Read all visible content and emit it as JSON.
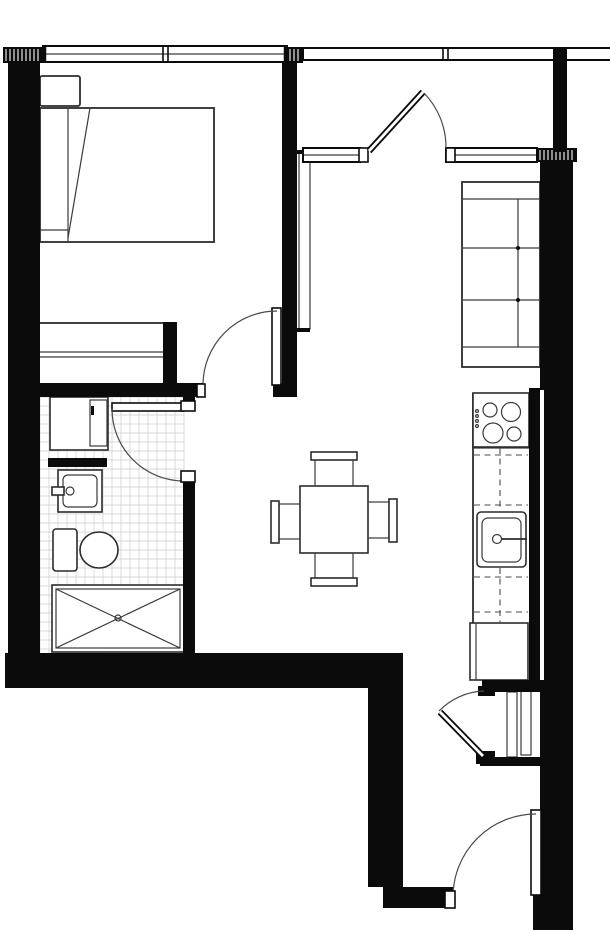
{
  "canvas": {
    "width": 610,
    "height": 932,
    "background": "#ffffff",
    "wall_color": "#0b0b0b",
    "line_color": "#3a3a3a"
  },
  "styles": {
    "wall": {
      "fill": "#0b0b0b"
    },
    "thin": {
      "stroke": "#3a3a3a",
      "sw": 1.2
    },
    "med": {
      "stroke": "#2c2c2c",
      "sw": 1.8
    },
    "fixture": {
      "fill": "#ffffff",
      "stroke": "#2c2c2c",
      "sw": 1.6
    },
    "cap": {
      "fill": "#ffffff",
      "stroke": "#0b0b0b",
      "sw": 1.6
    },
    "dash": {
      "stroke": "#4a4a4a",
      "sw": 1.1,
      "dash": "6 4.5"
    },
    "arc": {
      "stroke": "#4a4a4a",
      "sw": 1.2
    },
    "grid": {
      "stroke": "#cccccc",
      "sw": 0.7
    },
    "blk": {
      "fill": "#0b0b0b"
    }
  },
  "plan": {
    "elements": [
      {
        "n": "bathroom-floor-tiles",
        "t": "grid",
        "x": 40,
        "y": 397,
        "w": 144,
        "h": 256,
        "step": 9
      },
      {
        "n": "bed-frame",
        "t": "rect",
        "s": "med",
        "x": 40,
        "y": 108,
        "w": 174,
        "h": 134
      },
      {
        "n": "bed-pillow",
        "t": "rect",
        "s": "med",
        "x": 40,
        "y": 76,
        "w": 40,
        "h": 30,
        "rx": 2
      },
      {
        "n": "bed-inner-line",
        "t": "line",
        "s": "thin",
        "x1": 68,
        "y1": 108,
        "x2": 68,
        "y2": 242
      },
      {
        "n": "bed-fold-line",
        "t": "line",
        "s": "thin",
        "x1": 90,
        "y1": 108,
        "x2": 68,
        "y2": 238
      },
      {
        "n": "bed-foot-line",
        "t": "line",
        "s": "thin",
        "x1": 40,
        "y1": 230,
        "x2": 68,
        "y2": 230
      },
      {
        "n": "wardrobe",
        "t": "rect",
        "s": "med",
        "x": 39,
        "y": 323,
        "w": 129,
        "h": 62
      },
      {
        "n": "wardrobe-track-1",
        "t": "line",
        "s": "thin",
        "x1": 39,
        "y1": 352,
        "x2": 168,
        "y2": 352
      },
      {
        "n": "wardrobe-track-2",
        "t": "line",
        "s": "thin",
        "x1": 39,
        "y1": 357,
        "x2": 168,
        "y2": 357
      },
      {
        "n": "tv-panel",
        "t": "rect",
        "s": "thin",
        "x": 299,
        "y": 153,
        "w": 11,
        "h": 176
      },
      {
        "n": "tv-panel-mount-top",
        "t": "rect",
        "s": "blk",
        "x": 297,
        "y": 150,
        "w": 13,
        "h": 4
      },
      {
        "n": "tv-panel-mount-bottom",
        "t": "rect",
        "s": "blk",
        "x": 297,
        "y": 328,
        "w": 13,
        "h": 4
      },
      {
        "n": "sofa-outline",
        "t": "rect",
        "s": "med",
        "x": 462,
        "y": 182,
        "w": 78,
        "h": 185
      },
      {
        "n": "sofa-armrest-top-line",
        "t": "line",
        "s": "thin",
        "x1": 462,
        "y1": 199,
        "x2": 540,
        "y2": 199
      },
      {
        "n": "sofa-armrest-bottom-line",
        "t": "line",
        "s": "thin",
        "x1": 462,
        "y1": 347,
        "x2": 540,
        "y2": 347
      },
      {
        "n": "sofa-backrest-line",
        "t": "line",
        "s": "thin",
        "x1": 518,
        "y1": 199,
        "x2": 518,
        "y2": 347
      },
      {
        "n": "sofa-cushion-line-1",
        "t": "line",
        "s": "thin",
        "x1": 463,
        "y1": 248,
        "x2": 539,
        "y2": 248
      },
      {
        "n": "sofa-cushion-line-2",
        "t": "line",
        "s": "thin",
        "x1": 463,
        "y1": 300,
        "x2": 539,
        "y2": 300
      },
      {
        "n": "sofa-joint-dot-1",
        "t": "circle",
        "s": "blk",
        "cx": 518,
        "cy": 248,
        "r": 2
      },
      {
        "n": "sofa-joint-dot-2",
        "t": "circle",
        "s": "blk",
        "cx": 518,
        "cy": 300,
        "r": 2
      },
      {
        "n": "dining-table",
        "t": "rect",
        "s": "fixture",
        "x": 300,
        "y": 486,
        "w": 68,
        "h": 67
      },
      {
        "n": "chair-top-back",
        "t": "rect",
        "s": "fixture",
        "x": 311,
        "y": 452,
        "w": 46,
        "h": 8
      },
      {
        "n": "chair-top-seat",
        "t": "rect",
        "s": "thin",
        "x": 315,
        "y": 460,
        "w": 38,
        "h": 26
      },
      {
        "n": "chair-bottom-seat",
        "t": "rect",
        "s": "thin",
        "x": 315,
        "y": 553,
        "w": 38,
        "h": 25
      },
      {
        "n": "chair-bottom-back",
        "t": "rect",
        "s": "fixture",
        "x": 311,
        "y": 578,
        "w": 46,
        "h": 8
      },
      {
        "n": "chair-right-seat",
        "t": "rect",
        "s": "thin",
        "x": 368,
        "y": 502,
        "w": 21,
        "h": 36
      },
      {
        "n": "chair-right-back",
        "t": "rect",
        "s": "fixture",
        "x": 389,
        "y": 499,
        "w": 8,
        "h": 43
      },
      {
        "n": "chair-left-seat",
        "t": "rect",
        "s": "thin",
        "x": 279,
        "y": 504,
        "w": 21,
        "h": 35
      },
      {
        "n": "chair-left-back",
        "t": "rect",
        "s": "fixture",
        "x": 271,
        "y": 501,
        "w": 8,
        "h": 42
      },
      {
        "n": "kitchen-counter-edge",
        "t": "line",
        "s": "med",
        "x1": 473,
        "y1": 393,
        "x2": 473,
        "y2": 680
      },
      {
        "n": "counter-line-under-stove",
        "t": "line",
        "s": "thin",
        "x1": 473,
        "y1": 448,
        "x2": 529,
        "y2": 448
      },
      {
        "n": "stove",
        "t": "rect",
        "s": "fixture",
        "x": 473,
        "y": 393,
        "w": 56,
        "h": 54
      },
      {
        "n": "stove-burner-1",
        "t": "circle",
        "s": "thin",
        "cx": 490,
        "cy": 410,
        "r": 7
      },
      {
        "n": "stove-burner-2",
        "t": "circle",
        "s": "thin",
        "cx": 511,
        "cy": 412,
        "r": 9.5
      },
      {
        "n": "stove-burner-3",
        "t": "circle",
        "s": "thin",
        "cx": 493,
        "cy": 433,
        "r": 10
      },
      {
        "n": "stove-burner-4",
        "t": "circle",
        "s": "thin",
        "cx": 514,
        "cy": 434,
        "r": 7
      },
      {
        "n": "stove-control-dot-1",
        "t": "circle",
        "s": "thin",
        "cx": 477,
        "cy": 411,
        "r": 1.4
      },
      {
        "n": "stove-control-dot-2",
        "t": "circle",
        "s": "thin",
        "cx": 477,
        "cy": 416,
        "r": 1.4
      },
      {
        "n": "stove-control-dot-3",
        "t": "circle",
        "s": "thin",
        "cx": 477,
        "cy": 421,
        "r": 1.4
      },
      {
        "n": "stove-control-dot-4",
        "t": "circle",
        "s": "thin",
        "cx": 477,
        "cy": 426,
        "r": 1.4
      },
      {
        "n": "upper-cabinet-dash-1",
        "t": "line",
        "s": "dash",
        "x1": 500,
        "y1": 448,
        "x2": 500,
        "y2": 510
      },
      {
        "n": "upper-cabinet-dash-2",
        "t": "line",
        "s": "dash",
        "x1": 500,
        "y1": 568,
        "x2": 500,
        "y2": 622
      },
      {
        "n": "upper-cabinet-dash-3",
        "t": "line",
        "s": "dash",
        "x1": 474,
        "y1": 455,
        "x2": 528,
        "y2": 455
      },
      {
        "n": "upper-cabinet-dash-4",
        "t": "line",
        "s": "dash",
        "x1": 474,
        "y1": 505,
        "x2": 528,
        "y2": 505
      },
      {
        "n": "upper-cabinet-dash-5",
        "t": "line",
        "s": "dash",
        "x1": 474,
        "y1": 577,
        "x2": 528,
        "y2": 577
      },
      {
        "n": "upper-cabinet-dash-6",
        "t": "line",
        "s": "dash",
        "x1": 474,
        "y1": 612,
        "x2": 528,
        "y2": 612
      },
      {
        "n": "kitchen-sink",
        "t": "rect",
        "s": "fixture",
        "x": 477,
        "y": 512,
        "w": 49,
        "h": 55,
        "rx": 4
      },
      {
        "n": "kitchen-sink-basin",
        "t": "rect",
        "s": "thin",
        "x": 482,
        "y": 518,
        "w": 39,
        "h": 44,
        "rx": 6
      },
      {
        "n": "kitchen-faucet-knob",
        "t": "circle",
        "s": "thin",
        "cx": 497,
        "cy": 539,
        "r": 4.5
      },
      {
        "n": "kitchen-faucet-stem",
        "t": "line",
        "s": "med",
        "x1": 501,
        "y1": 539,
        "x2": 527,
        "y2": 539
      },
      {
        "n": "refrigerator",
        "t": "rect",
        "s": "fixture",
        "x": 470,
        "y": 623,
        "w": 58,
        "h": 57
      },
      {
        "n": "refrigerator-door-line",
        "t": "line",
        "s": "thin",
        "x1": 476,
        "y1": 623,
        "x2": 476,
        "y2": 680
      },
      {
        "n": "hall-closet-slide-panel-1",
        "t": "rect",
        "s": "thin",
        "x": 507,
        "y": 692,
        "w": 10,
        "h": 65
      },
      {
        "n": "hall-closet-slide-panel-2",
        "t": "rect",
        "s": "thin",
        "x": 521,
        "y": 690,
        "w": 10,
        "h": 65
      },
      {
        "n": "vanity-cabinet",
        "t": "rect",
        "s": "fixture",
        "x": 50,
        "y": 397,
        "w": 58,
        "h": 53
      },
      {
        "n": "vanity-door",
        "t": "rect",
        "s": "thin",
        "x": 90,
        "y": 400,
        "w": 17,
        "h": 46
      },
      {
        "n": "vanity-door-hinge",
        "t": "rect",
        "s": "blk",
        "x": 91,
        "y": 406,
        "w": 3,
        "h": 9
      },
      {
        "n": "bathroom-basin",
        "t": "rect",
        "s": "fixture",
        "x": 58,
        "y": 470,
        "w": 44,
        "h": 42
      },
      {
        "n": "bathroom-basin-inner",
        "t": "rect",
        "s": "thin",
        "x": 63,
        "y": 475,
        "w": 34,
        "h": 32,
        "rx": 5
      },
      {
        "n": "bathroom-faucet",
        "t": "rect",
        "s": "fixture",
        "x": 52,
        "y": 487,
        "w": 12,
        "h": 8
      },
      {
        "n": "bathroom-faucet-knob",
        "t": "circle",
        "s": "thin",
        "cx": 70,
        "cy": 491,
        "r": 4
      },
      {
        "n": "toilet-tank",
        "t": "rect",
        "s": "fixture",
        "x": 53,
        "y": 529,
        "w": 24,
        "h": 42,
        "rx": 3
      },
      {
        "n": "toilet-bowl",
        "t": "ellipse",
        "s": "fixture",
        "cx": 99,
        "cy": 550,
        "rx": 19,
        "ry": 18
      },
      {
        "n": "shower",
        "t": "rect",
        "s": "fixture",
        "x": 52,
        "y": 585,
        "w": 132,
        "h": 67
      },
      {
        "n": "shower-inner",
        "t": "rect",
        "s": "thin",
        "x": 56,
        "y": 589,
        "w": 124,
        "h": 59
      },
      {
        "n": "shower-x-line-1",
        "t": "line",
        "s": "thin",
        "x1": 56,
        "y1": 589,
        "x2": 180,
        "y2": 648
      },
      {
        "n": "shower-x-line-2",
        "t": "line",
        "s": "thin",
        "x1": 180,
        "y1": 589,
        "x2": 56,
        "y2": 648
      },
      {
        "n": "shower-drain",
        "t": "circle",
        "s": "thin",
        "cx": 118,
        "cy": 618,
        "r": 3
      },
      {
        "n": "left-exterior-wall",
        "t": "rect",
        "s": "wall",
        "x": 8,
        "y": 55,
        "w": 32,
        "h": 633
      },
      {
        "n": "bedroom-right-wall",
        "t": "rect",
        "s": "wall",
        "x": 282,
        "y": 60,
        "w": 15,
        "h": 337
      },
      {
        "n": "bathroom-top-wall",
        "t": "rect",
        "s": "wall",
        "x": 30,
        "y": 383,
        "w": 173,
        "h": 14
      },
      {
        "n": "wardrobe-side-wall-stub",
        "t": "rect",
        "s": "wall",
        "x": 163,
        "y": 322,
        "w": 14,
        "h": 61
      },
      {
        "n": "bedroom-door-side-block",
        "t": "rect",
        "s": "wall",
        "x": 273,
        "y": 383,
        "w": 24,
        "h": 14
      },
      {
        "n": "bathroom-right-wall-upper",
        "t": "rect",
        "s": "wall",
        "x": 183,
        "y": 383,
        "w": 12,
        "h": 20
      },
      {
        "n": "bathroom-right-wall-lower",
        "t": "rect",
        "s": "wall",
        "x": 183,
        "y": 479,
        "w": 12,
        "h": 176
      },
      {
        "n": "bottom-exterior-wall",
        "t": "rect",
        "s": "wall",
        "x": 5,
        "y": 653,
        "w": 398,
        "h": 35
      },
      {
        "n": "corridor-left-wall",
        "t": "rect",
        "s": "wall",
        "x": 368,
        "y": 683,
        "w": 35,
        "h": 204
      },
      {
        "n": "entry-left-wall-block",
        "t": "rect",
        "s": "wall",
        "x": 383,
        "y": 887,
        "w": 70,
        "h": 21
      },
      {
        "n": "right-wall-upper",
        "t": "rect",
        "s": "wall",
        "x": 540,
        "y": 162,
        "w": 33,
        "h": 228
      },
      {
        "n": "right-wall-outer-mid",
        "t": "rect",
        "s": "wall",
        "x": 544,
        "y": 390,
        "w": 29,
        "h": 300
      },
      {
        "n": "right-wall-lower",
        "t": "rect",
        "s": "wall",
        "x": 540,
        "y": 683,
        "w": 33,
        "h": 247
      },
      {
        "n": "kitchen-chase-wall",
        "t": "rect",
        "s": "wall",
        "x": 529,
        "y": 388,
        "w": 11,
        "h": 295
      },
      {
        "n": "hall-closet-top-wall",
        "t": "rect",
        "s": "wall",
        "x": 482,
        "y": 680,
        "w": 62,
        "h": 12
      },
      {
        "n": "hall-closet-bottom-wall",
        "t": "rect",
        "s": "wall",
        "x": 480,
        "y": 757,
        "w": 63,
        "h": 9
      },
      {
        "n": "entry-right-corner-block",
        "t": "rect",
        "s": "wall",
        "x": 533,
        "y": 893,
        "w": 40,
        "h": 37
      },
      {
        "n": "vanity-counter-edge",
        "t": "rect",
        "s": "wall",
        "x": 48,
        "y": 458,
        "w": 59,
        "h": 9
      },
      {
        "n": "hall-closet-door-jamb",
        "t": "rect",
        "s": "wall",
        "x": 478,
        "y": 686,
        "w": 17,
        "h": 10
      },
      {
        "n": "hall-closet-door-hinge",
        "t": "rect",
        "s": "wall",
        "x": 476,
        "y": 751,
        "w": 19,
        "h": 13
      },
      {
        "n": "wall-hatch-left",
        "t": "hatch",
        "x": 3,
        "y": 47,
        "w": 40,
        "h": 16
      },
      {
        "n": "wall-hatch-mid",
        "t": "hatch",
        "x": 287,
        "y": 47,
        "w": 16,
        "h": 16
      },
      {
        "n": "wall-hatch-right",
        "t": "hatch",
        "x": 537,
        "y": 148,
        "w": 40,
        "h": 14
      },
      {
        "n": "bedroom-window",
        "t": "window",
        "x": 43,
        "y": 46,
        "w": 244,
        "h": 16,
        "mid": true,
        "ticks": [
          120,
          125
        ],
        "caps": true
      },
      {
        "n": "balcony-railing",
        "t": "window",
        "x": 303,
        "y": 48,
        "w": 309,
        "h": 12,
        "mid": false,
        "ticks": [
          140,
          145
        ],
        "caps": false
      },
      {
        "n": "balcony-sill-left",
        "t": "window",
        "x": 303,
        "y": 148,
        "w": 57,
        "h": 14,
        "mid": true,
        "ticks": [],
        "caps": false
      },
      {
        "n": "balcony-sill-right",
        "t": "window",
        "x": 446,
        "y": 148,
        "w": 91,
        "h": 14,
        "mid": true,
        "ticks": [],
        "caps": false
      },
      {
        "n": "balcony-sill-left-cap",
        "t": "rect",
        "s": "cap",
        "x": 359,
        "y": 148,
        "w": 9,
        "h": 14
      },
      {
        "n": "balcony-sill-right-cap",
        "t": "rect",
        "s": "cap",
        "x": 446,
        "y": 148,
        "w": 9,
        "h": 14
      },
      {
        "n": "balcony-side-wall-stub",
        "t": "rect",
        "s": "wall",
        "x": 553,
        "y": 47,
        "w": 14,
        "h": 105
      },
      {
        "n": "bedroom-door-leaf",
        "t": "rect",
        "s": "cap",
        "x": 272,
        "y": 308,
        "w": 9,
        "h": 77
      },
      {
        "n": "bedroom-door-swing",
        "t": "arc",
        "d": "M 203 385 A 74 74 0 0 1 277 311"
      },
      {
        "n": "bedroom-door-jamb-cap",
        "t": "rect",
        "s": "cap",
        "x": 197,
        "y": 384,
        "w": 8,
        "h": 13
      },
      {
        "n": "bathroom-door-leaf",
        "t": "rect",
        "s": "cap",
        "x": 112,
        "y": 403,
        "w": 71,
        "h": 8
      },
      {
        "n": "bathroom-door-swing",
        "t": "arc",
        "d": "M 112 409 A 72 72 0 0 0 184 481"
      },
      {
        "n": "bathroom-door-stop-top",
        "t": "rect",
        "s": "cap",
        "x": 181,
        "y": 401,
        "w": 14,
        "h": 10
      },
      {
        "n": "bathroom-door-stop-bottom",
        "t": "rect",
        "s": "cap",
        "x": 181,
        "y": 471,
        "w": 14,
        "h": 11
      },
      {
        "n": "balcony-door-leaf",
        "t": "dline",
        "x1": 369,
        "y1": 151,
        "x2": 423,
        "y2": 92
      },
      {
        "n": "balcony-door-swing",
        "t": "arc",
        "d": "M 424 93 A 78 78 0 0 1 446 148"
      },
      {
        "n": "hall-closet-door-leaf",
        "t": "dline",
        "x1": 483,
        "y1": 756,
        "x2": 440,
        "y2": 712
      },
      {
        "n": "hall-closet-door-swing",
        "t": "arc",
        "d": "M 484 691 A 66 66 0 0 0 439 711"
      },
      {
        "n": "entry-door-leaf",
        "t": "rect",
        "s": "cap",
        "x": 531,
        "y": 810,
        "w": 10,
        "h": 85
      },
      {
        "n": "entry-door-swing",
        "t": "arc",
        "d": "M 453 897 A 83 83 0 0 1 536 814"
      },
      {
        "n": "entry-door-jamb-cap",
        "t": "rect",
        "s": "cap",
        "x": 445,
        "y": 891,
        "w": 10,
        "h": 17
      }
    ]
  }
}
